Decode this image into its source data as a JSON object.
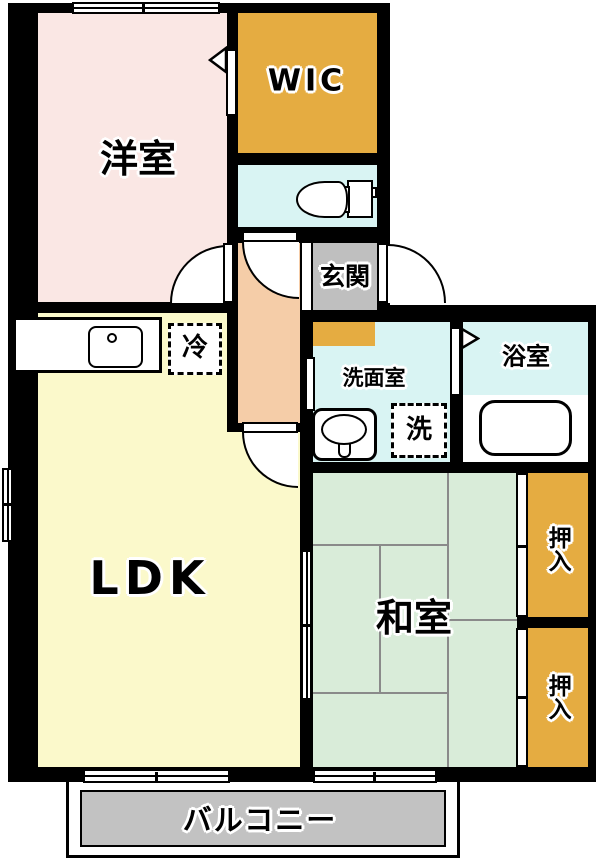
{
  "plan": {
    "rooms": {
      "western_room": "洋室",
      "wic": "WIC",
      "entrance": "玄関",
      "washroom": "洗面室",
      "bathroom": "浴室",
      "ldk": "LDK",
      "japanese_room": "和室",
      "closet_upper": "押入",
      "closet_lower": "押入",
      "balcony": "バルコニー"
    },
    "fixtures": {
      "fridge": "冷",
      "washer": "洗"
    },
    "colors": {
      "wall": "#000000",
      "western_room": "#FAE7E4",
      "wic_and_closets": "#E5AC41",
      "wet_rooms": "#D9F4F3",
      "hallway": "#F5CDA8",
      "entrance_floor": "#BFBFBF",
      "entrance_step": "#E5AC41",
      "ldk": "#FBF9CB",
      "japanese_room": "#D9ECD9",
      "balcony_floor": "#C2C2C2"
    }
  }
}
